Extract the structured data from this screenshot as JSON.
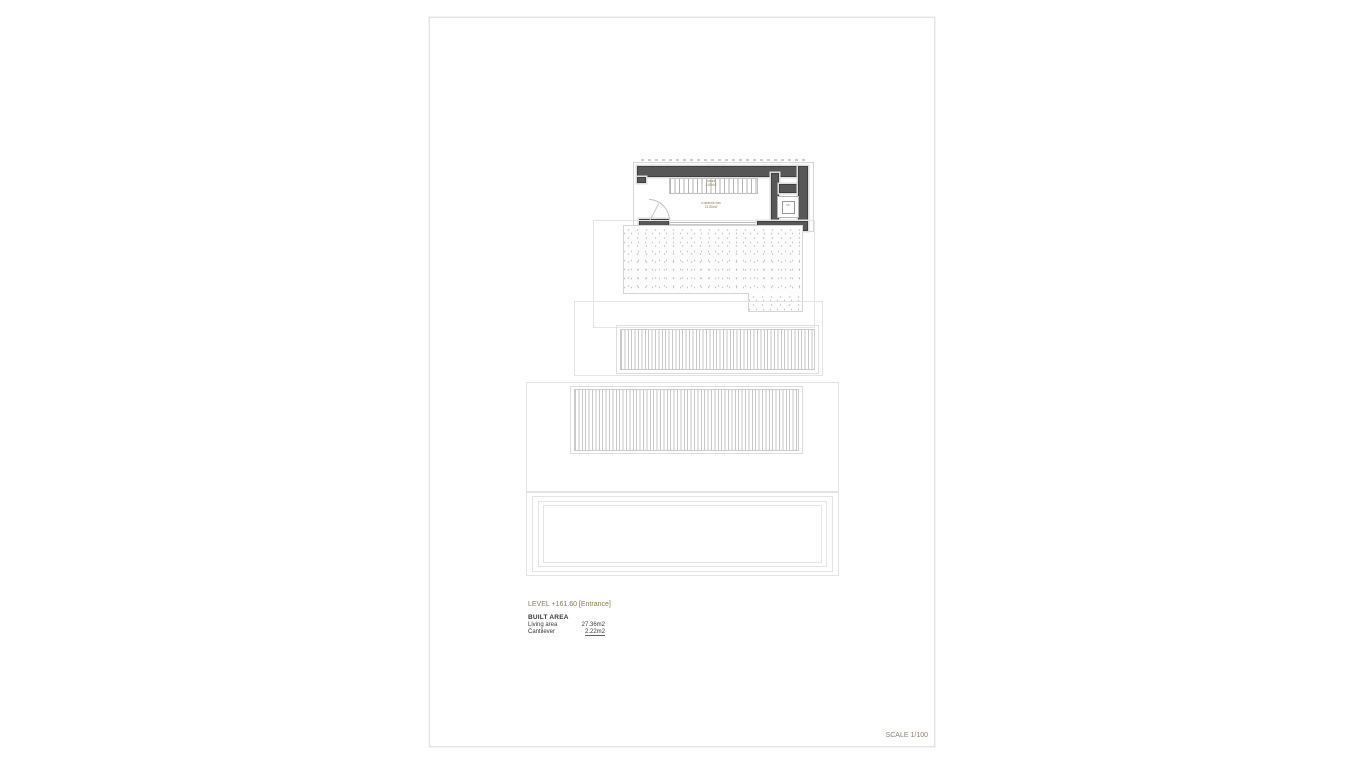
{
  "annotation": {
    "level_title": "LEVEL +161.60 [Entrance]",
    "built_area_heading": "BUILT AREA",
    "area_rows": [
      {
        "label": "Living area",
        "value": "27.36m2"
      },
      {
        "label": "Cantilever",
        "value": "2.22m2"
      }
    ],
    "scale_label": "SCALE 1/100"
  },
  "plan_labels": {
    "stairs_name": "Stairs",
    "stairs_area": "3.85m2",
    "room_name": "Entrance hall",
    "room_area": "13.85m2",
    "lift_label": "lift"
  },
  "colors": {
    "accent_text": "#8d7c52",
    "wall_fill": "#575757",
    "thin_line": "#dedede",
    "sheet_border": "#e3e3e3"
  }
}
